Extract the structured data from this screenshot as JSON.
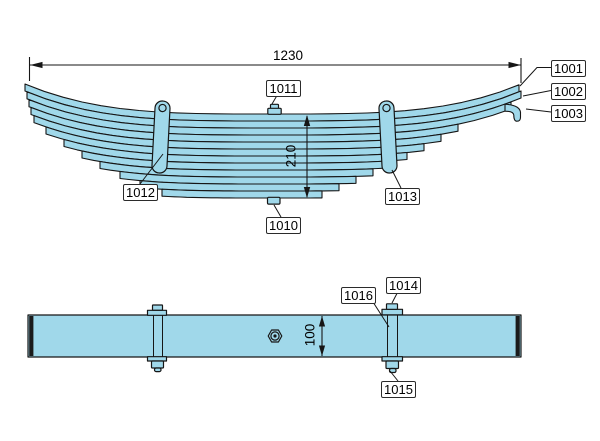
{
  "drawing": {
    "colors": {
      "leaf_fill": "#a0d8ea",
      "outline": "#161616",
      "callout_bg": "#ffffff",
      "callout_border": "#2b2b2b"
    },
    "side_view": {
      "length_dimension": "1230",
      "height_dimension": "210",
      "callouts": {
        "c1001": "1001",
        "c1002": "1002",
        "c1003": "1003",
        "c1010": "1010",
        "c1011": "1011",
        "c1012": "1012",
        "c1013": "1013"
      }
    },
    "top_view": {
      "width_dimension": "100",
      "callouts": {
        "c1014": "1014",
        "c1015": "1015",
        "c1016": "1016"
      }
    }
  }
}
